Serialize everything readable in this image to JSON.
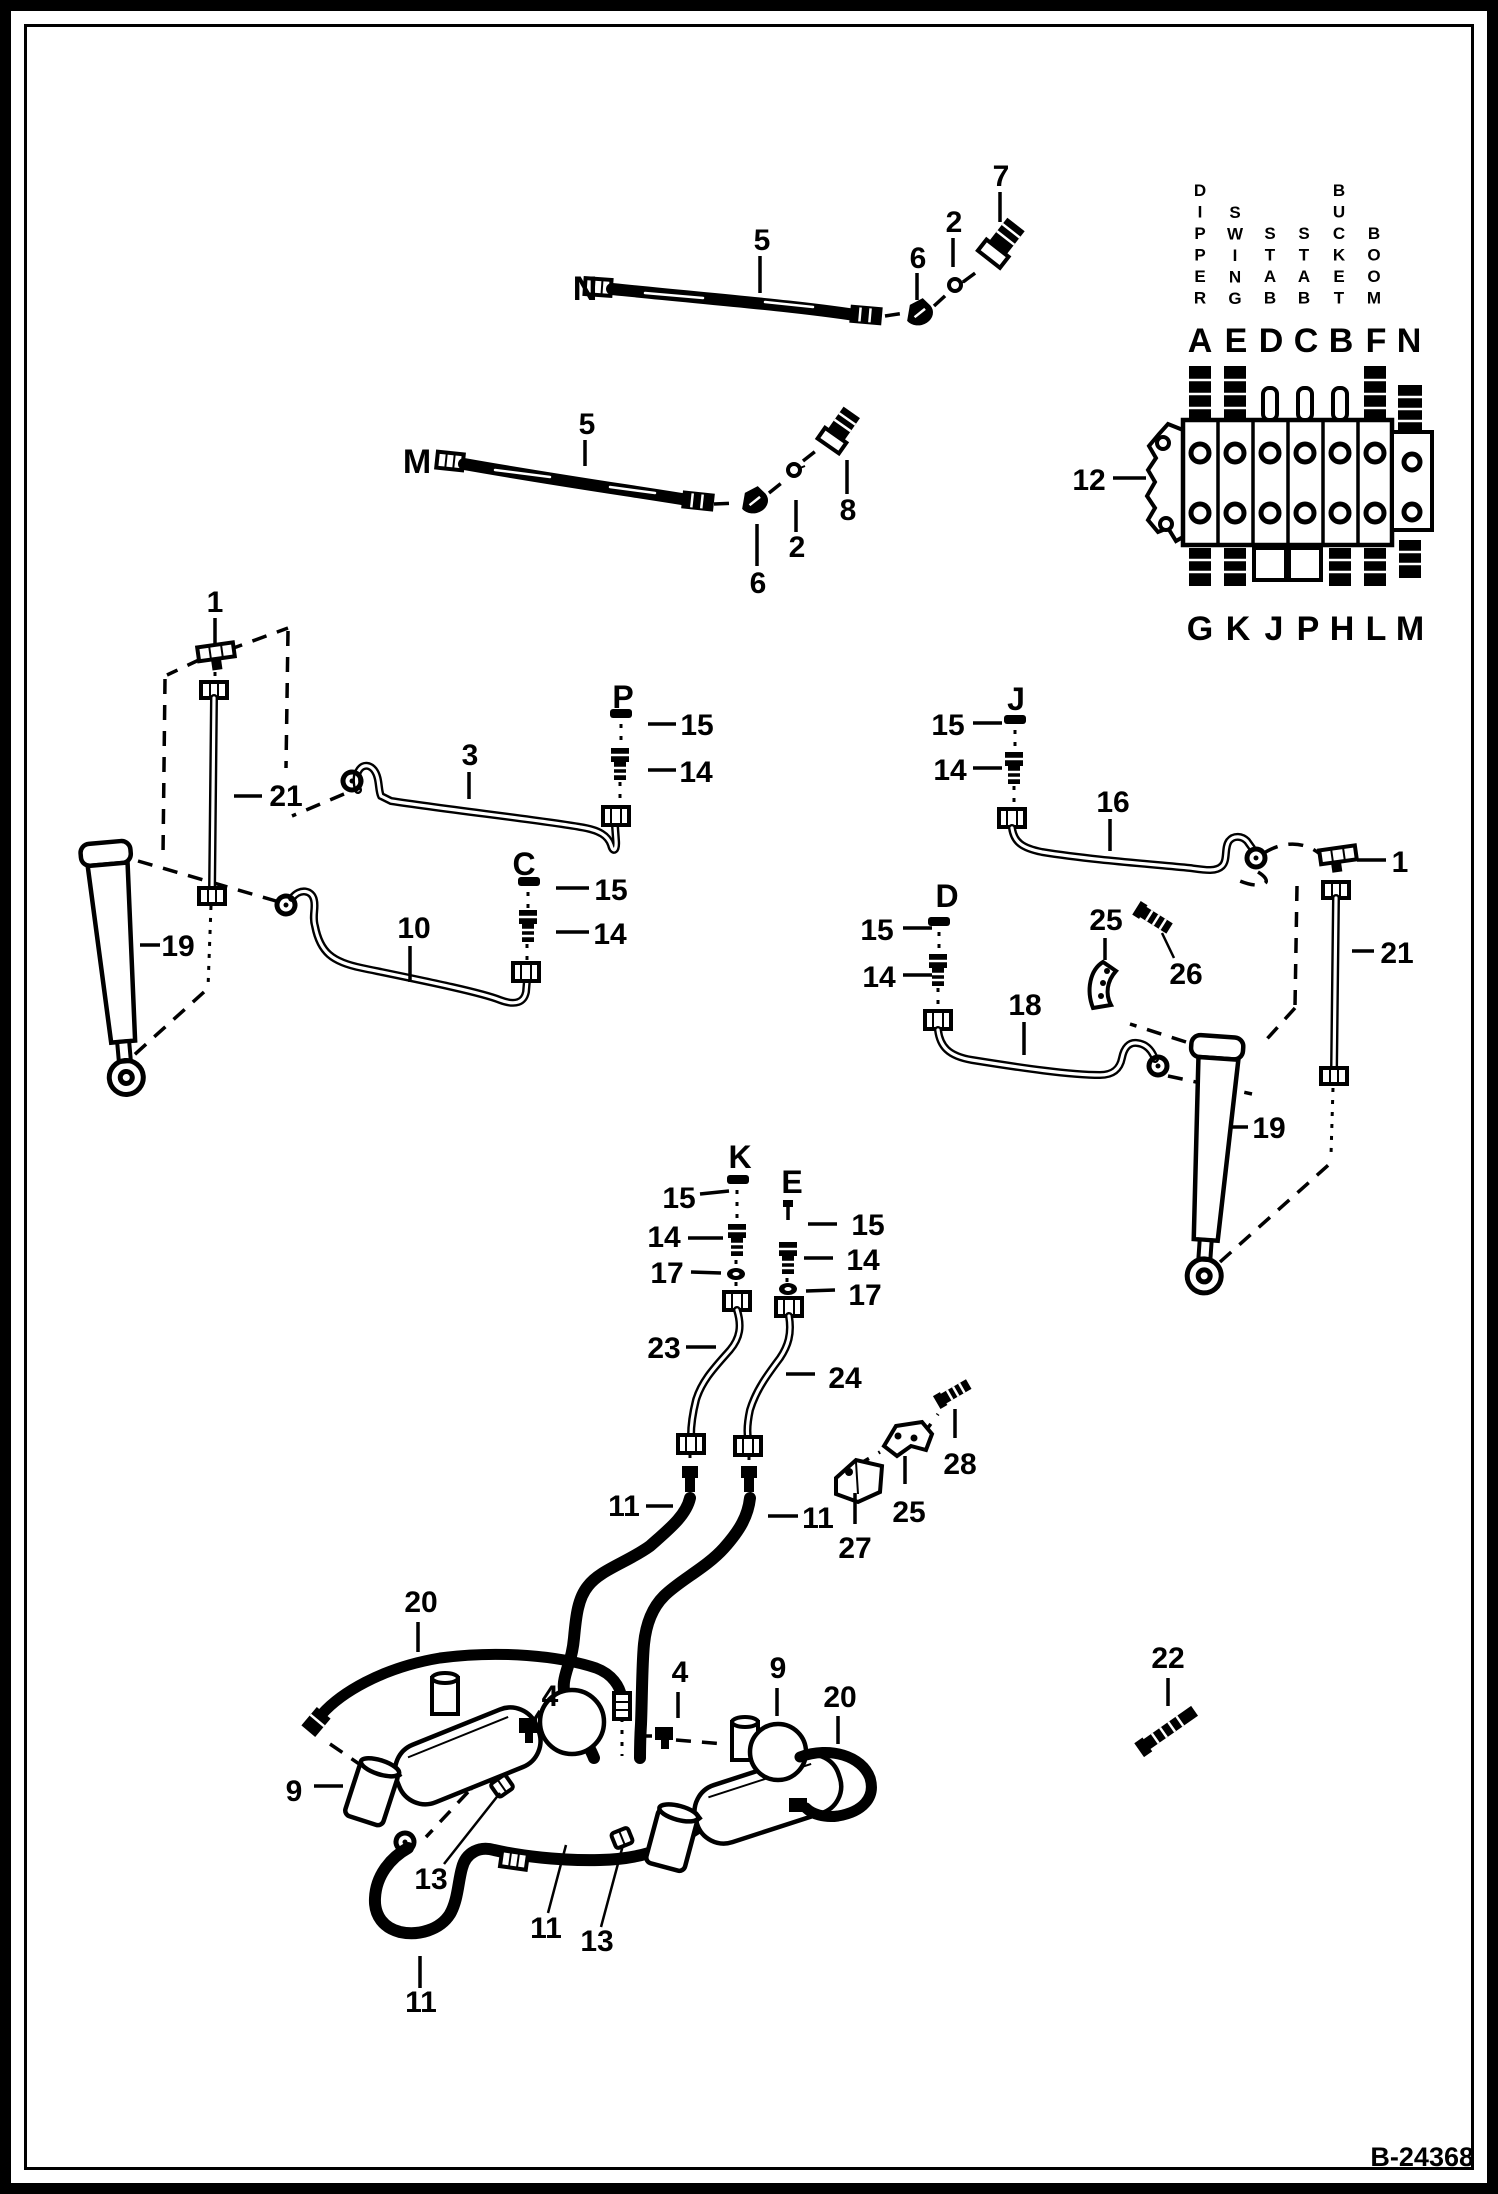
{
  "figure": {
    "code": "B-24368"
  },
  "valve": {
    "callout": "12",
    "vertical_labels": [
      {
        "text": "DIPPER",
        "x": 1200,
        "y": 196
      },
      {
        "text": "SWING",
        "x": 1235,
        "y": 218
      },
      {
        "text": "STAB",
        "x": 1270,
        "y": 239
      },
      {
        "text": "STAB",
        "x": 1304,
        "y": 239
      },
      {
        "text": "BUCKET",
        "x": 1339,
        "y": 196
      },
      {
        "text": "BOOM",
        "x": 1374,
        "y": 239
      }
    ],
    "top_ports": [
      {
        "t": "A",
        "x": 1200
      },
      {
        "t": "E",
        "x": 1236
      },
      {
        "t": "D",
        "x": 1271
      },
      {
        "t": "C",
        "x": 1306
      },
      {
        "t": "B",
        "x": 1341
      },
      {
        "t": "F",
        "x": 1376
      },
      {
        "t": "N",
        "x": 1409
      }
    ],
    "bottom_ports": [
      {
        "t": "G",
        "x": 1200
      },
      {
        "t": "K",
        "x": 1238
      },
      {
        "t": "J",
        "x": 1274
      },
      {
        "t": "P",
        "x": 1308
      },
      {
        "t": "H",
        "x": 1342
      },
      {
        "t": "L",
        "x": 1376
      },
      {
        "t": "M",
        "x": 1410
      }
    ]
  },
  "callouts": [
    {
      "t": "7",
      "x": 1001,
      "y": 186
    },
    {
      "t": "2",
      "x": 954,
      "y": 232
    },
    {
      "t": "6",
      "x": 918,
      "y": 268
    },
    {
      "t": "5",
      "x": 762,
      "y": 250
    },
    {
      "t": "N",
      "x": 585,
      "y": 300,
      "s": 34
    },
    {
      "t": "5",
      "x": 587,
      "y": 434
    },
    {
      "t": "M",
      "x": 417,
      "y": 473,
      "s": 34
    },
    {
      "t": "2",
      "x": 797,
      "y": 557
    },
    {
      "t": "6",
      "x": 758,
      "y": 593
    },
    {
      "t": "8",
      "x": 848,
      "y": 520
    },
    {
      "t": "12",
      "x": 1089,
      "y": 490
    },
    {
      "t": "1",
      "x": 215,
      "y": 612
    },
    {
      "t": "21",
      "x": 286,
      "y": 806
    },
    {
      "t": "19",
      "x": 178,
      "y": 956
    },
    {
      "t": "3",
      "x": 470,
      "y": 765
    },
    {
      "t": "P",
      "x": 623,
      "y": 708,
      "s": 32
    },
    {
      "t": "15",
      "x": 697,
      "y": 735
    },
    {
      "t": "14",
      "x": 696,
      "y": 782
    },
    {
      "t": "C",
      "x": 524,
      "y": 875,
      "s": 32
    },
    {
      "t": "15",
      "x": 611,
      "y": 900
    },
    {
      "t": "14",
      "x": 610,
      "y": 944
    },
    {
      "t": "10",
      "x": 414,
      "y": 938
    },
    {
      "t": "J",
      "x": 1016,
      "y": 710,
      "s": 32
    },
    {
      "t": "15",
      "x": 948,
      "y": 735
    },
    {
      "t": "14",
      "x": 950,
      "y": 780
    },
    {
      "t": "16",
      "x": 1113,
      "y": 812
    },
    {
      "t": "D",
      "x": 947,
      "y": 907,
      "s": 32
    },
    {
      "t": "15",
      "x": 877,
      "y": 940
    },
    {
      "t": "14",
      "x": 879,
      "y": 987
    },
    {
      "t": "18",
      "x": 1025,
      "y": 1015
    },
    {
      "t": "25",
      "x": 1106,
      "y": 930
    },
    {
      "t": "26",
      "x": 1186,
      "y": 984
    },
    {
      "t": "1",
      "x": 1400,
      "y": 872
    },
    {
      "t": "21",
      "x": 1397,
      "y": 963
    },
    {
      "t": "19",
      "x": 1269,
      "y": 1138
    },
    {
      "t": "K",
      "x": 740,
      "y": 1168,
      "s": 32
    },
    {
      "t": "E",
      "x": 792,
      "y": 1193,
      "s": 32
    },
    {
      "t": "15",
      "x": 679,
      "y": 1208
    },
    {
      "t": "14",
      "x": 664,
      "y": 1247
    },
    {
      "t": "17",
      "x": 667,
      "y": 1283
    },
    {
      "t": "15",
      "x": 868,
      "y": 1235
    },
    {
      "t": "14",
      "x": 863,
      "y": 1270
    },
    {
      "t": "17",
      "x": 865,
      "y": 1305
    },
    {
      "t": "23",
      "x": 664,
      "y": 1358
    },
    {
      "t": "24",
      "x": 845,
      "y": 1388
    },
    {
      "t": "28",
      "x": 960,
      "y": 1474
    },
    {
      "t": "25",
      "x": 909,
      "y": 1522
    },
    {
      "t": "27",
      "x": 855,
      "y": 1558
    },
    {
      "t": "11",
      "x": 624,
      "y": 1516
    },
    {
      "t": "11",
      "x": 818,
      "y": 1528
    },
    {
      "t": "20",
      "x": 421,
      "y": 1612
    },
    {
      "t": "4",
      "x": 550,
      "y": 1706
    },
    {
      "t": "9",
      "x": 294,
      "y": 1801
    },
    {
      "t": "13",
      "x": 431,
      "y": 1889
    },
    {
      "t": "11",
      "x": 421,
      "y": 2012
    },
    {
      "t": "11",
      "x": 546,
      "y": 1938
    },
    {
      "t": "13",
      "x": 597,
      "y": 1951
    },
    {
      "t": "4",
      "x": 680,
      "y": 1682
    },
    {
      "t": "9",
      "x": 778,
      "y": 1678
    },
    {
      "t": "20",
      "x": 840,
      "y": 1707
    },
    {
      "t": "22",
      "x": 1168,
      "y": 1668
    }
  ]
}
